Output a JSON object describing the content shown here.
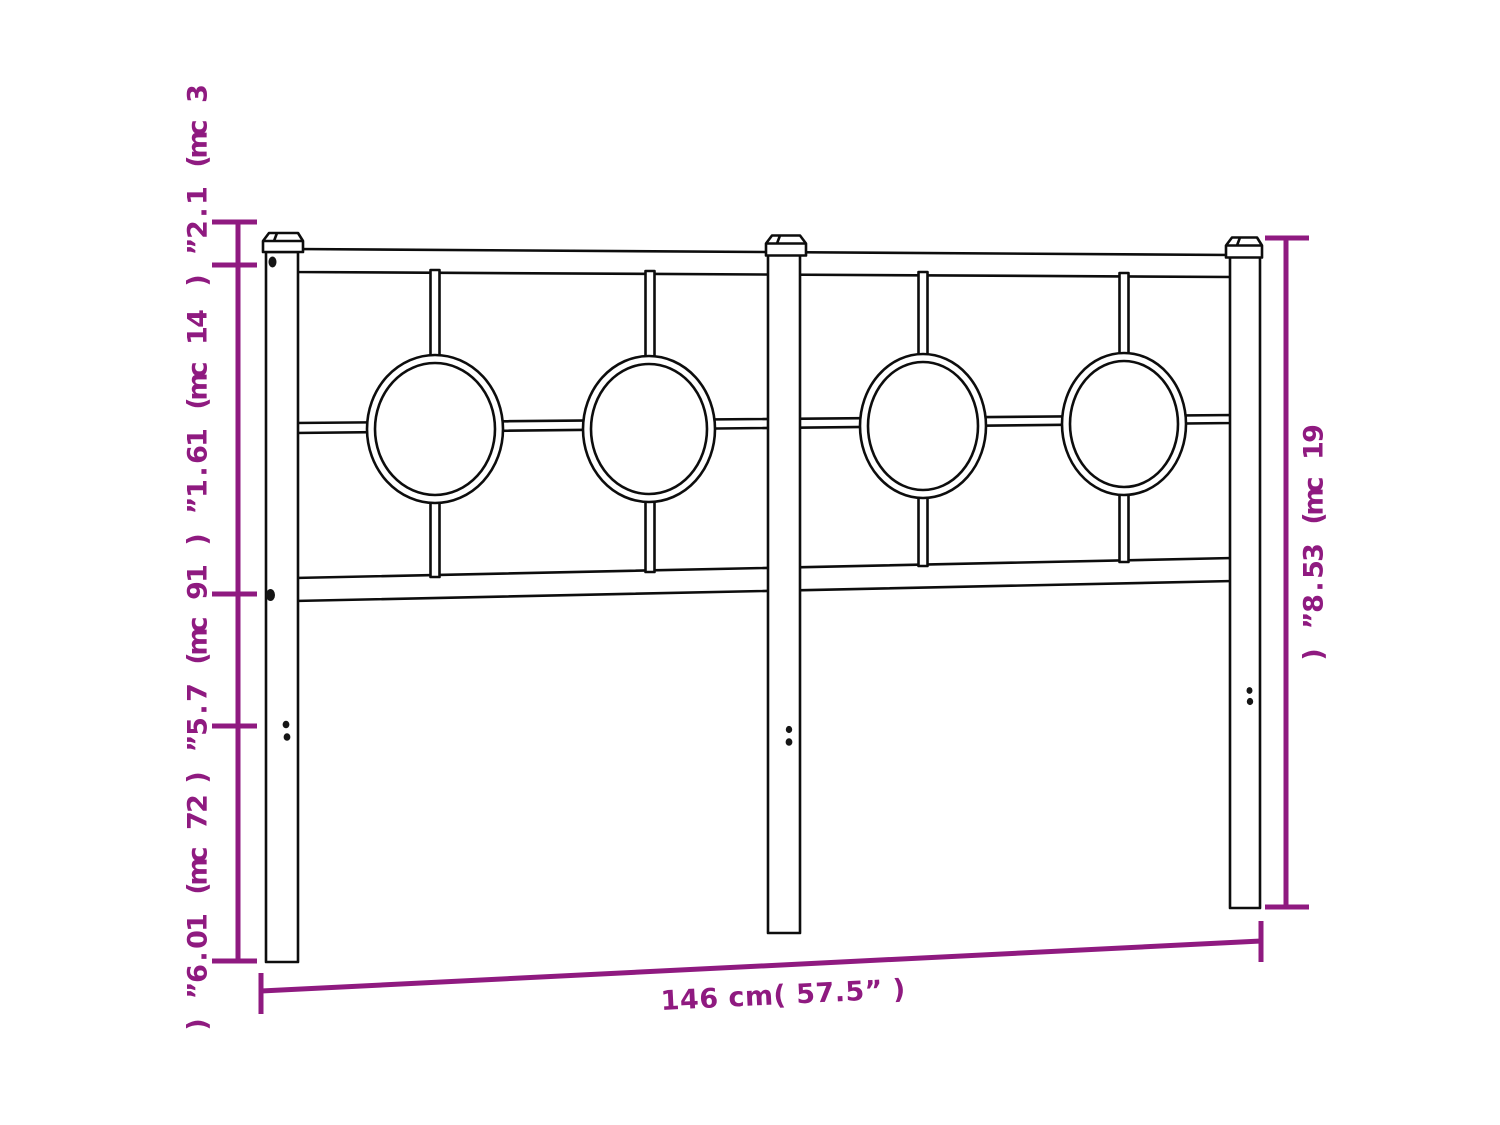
{
  "diagram": {
    "subject": "metal-headboard-dimension-diagram",
    "style": {
      "accent_color": "#8f1a80",
      "line_color": "#0d0d0d",
      "background": "#ffffff"
    },
    "dimensions": {
      "left_segments": [
        {
          "cm": 3,
          "inch": 1.2,
          "label": "3 cm( 1.2” )"
        },
        {
          "cm": 41,
          "inch": 16.1,
          "label": "41 cm( 16.1” )"
        },
        {
          "cm": 19,
          "inch": 7.5,
          "label": "19 cm( 7.5” )"
        },
        {
          "cm": 27,
          "inch": 10.6,
          "label": "27 cm( 10.6” )"
        }
      ],
      "total_height": {
        "cm": 91,
        "inch": 35.8,
        "label": "91 cm( 35.8” )"
      },
      "total_width": {
        "cm": 146,
        "inch": 57.5,
        "label": "146 cm( 57.5” )"
      }
    }
  }
}
